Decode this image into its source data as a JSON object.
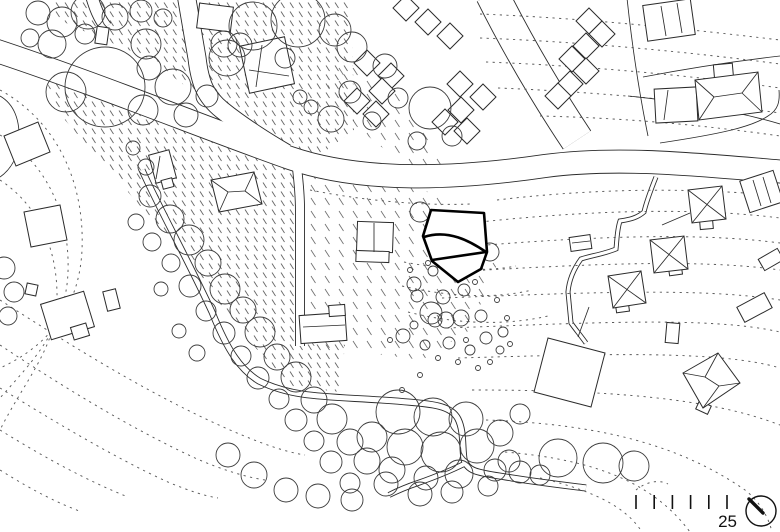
{
  "colors": {
    "background": "#ffffff",
    "ink": "#2b2b2b",
    "contour": "#5a5a5a",
    "bold_outline": "#000000"
  },
  "scale_bar": {
    "label": "25",
    "tick_count": 6,
    "x0": 636,
    "step": 18.2,
    "y1": 495,
    "y2": 509
  },
  "north_symbol": {
    "cx": 761,
    "cy": 511,
    "r": 15,
    "hand": [
      749,
      499,
      763,
      513
    ]
  },
  "plan": {
    "hatch_regions": [
      {
        "density": "dense",
        "pts": "35,50 120,85 210,125 290,158 305,175 305,330 345,345 340,392 288,386 232,320 178,250 122,185 58,112"
      },
      {
        "density": "dense",
        "pts": "55,0 352,0 354,130 302,168 228,118 148,58 86,32 55,18"
      },
      {
        "density": "sparse",
        "pts": "308,172 420,188 468,212 498,262 470,330 422,360 308,345"
      },
      {
        "density": "sparse",
        "pts": "336,58 396,92 428,138 466,184 420,178 358,128 326,92"
      }
    ],
    "roads": [
      {
        "d": "M-6,50 C100,85 210,130 290,158 C360,182 450,180 545,166 C620,156 700,165 786,172",
        "w": 24
      },
      {
        "d": "M186,-6 L197,58 C200,84 206,97 222,110 C242,126 262,139 286,153",
        "w": 19
      },
      {
        "d": "M91,-6 C95,8 99,18 106,27",
        "w": 13
      },
      {
        "d": "M297,168 C299,185 300,195 300,210 L300,346",
        "w": 10
      },
      {
        "d": "M142,170 C160,210 186,256 212,312 C228,352 241,370 259,381 C296,399 330,396 396,401 C432,404 451,405 458,419 C464,431 462,446 464,459 C467,473 482,473 512,478 C537,482 562,485 586,488",
        "w": 7
      },
      {
        "d": "M464,464 C448,472 432,478 418,483 C406,487 397,491 389,495",
        "w": 6
      },
      {
        "d": "M492,-6 C515,40 545,92 577,140",
        "w": 34
      },
      {
        "d": "M656,177 C650,192 646,203 644,212 C636,219 626,220 620,221 C617,230 617,240 616,249 C604,254 590,256 581,259 C573,270 569,280 568,292 C569,303 570,313 571,323 C576,330 581,336 586,343",
        "w": 5
      }
    ],
    "contours": [
      "M480,14 C580,18 680,28 780,40",
      "M480,38 C585,42 690,52 780,64",
      "M486,62 C590,66 695,76 780,88",
      "M498,88 C600,92 700,102 780,113",
      "M540,116 C630,118 710,126 780,136",
      "M310,190 C360,200 420,206 470,204",
      "M497,200 C580,190 680,186 780,196",
      "M480,222 C575,212 685,206 780,218",
      "M462,247 C570,238 690,231 780,243",
      "M450,272 C575,265 695,258 780,270",
      "M442,298 C580,293 700,287 780,300",
      "M447,328 C590,323 710,316 780,332",
      "M458,358 C600,354 720,350 780,368",
      "M472,390 C610,390 710,398 780,425",
      "M486,420 C600,424 680,445 745,490 C758,500 768,515 772,532",
      "M505,452 C600,460 655,485 690,532",
      "M540,478 C600,492 628,510 642,532",
      "M404,262 C445,270 485,272 516,266",
      "M402,286 C450,297 495,299 532,290",
      "M408,312 C455,324 505,326 548,316",
      "M0,90 C55,120 85,180 82,250 C79,315 40,350 0,368",
      "M0,135 C45,162 70,212 68,272 C66,328 32,362 0,398",
      "M0,180 C38,205 58,248 57,300 C56,348 25,380 0,430",
      "M0,300 C70,345 150,395 230,430 C260,443 285,452 305,455",
      "M0,345 C60,385 130,428 195,458 C220,469 245,477 265,480",
      "M0,388 C55,422 115,458 170,483 C190,491 205,496 218,498",
      "M0,430 C45,458 90,482 128,497",
      "M0,470 C35,492 60,504 82,512",
      "M636,490 C646,482 658,479 668,484"
    ],
    "parcel_lines": [
      "M643,77 C700,66 745,60 780,56",
      "M628,96 C680,101 740,112 780,124",
      "M627,-2 C632,45 639,92 648,136",
      "M660,143 C720,134 752,127 768,116 C778,110 780,102 779,90",
      "M662,225 L690,213",
      "M578,337 L589,307",
      "M0,96 C14,104 20,120 19,140 C18,158 10,170 0,177"
    ],
    "buildings": {
      "rects": [
        {
          "r": [
            198,
            5,
            34,
            25
          ],
          "a": 7
        },
        {
          "r": [
            244,
            41,
            46,
            48
          ],
          "a": -12
        },
        {
          "r": [
            96,
            27,
            12,
            17
          ],
          "a": 8
        },
        {
          "r": [
            152,
            152,
            21,
            29
          ],
          "a": -15
        },
        {
          "r": [
            162,
            179,
            11,
            9
          ],
          "a": -15
        },
        {
          "r": [
            357,
            222,
            36,
            30
          ],
          "a": 2
        },
        {
          "r": [
            356,
            251,
            33,
            11
          ],
          "a": 2
        },
        {
          "r": [
            300,
            314,
            46,
            28
          ],
          "a": -4
        },
        {
          "r": [
            329,
            305,
            16,
            11
          ],
          "a": -4
        },
        {
          "r": [
            655,
            88,
            42,
            34
          ],
          "a": -3
        },
        {
          "r": [
            714,
            64,
            19,
            16
          ],
          "a": -5
        },
        {
          "r": [
            645,
            2,
            48,
            36
          ],
          "a": -8
        },
        {
          "r": [
            744,
            175,
            35,
            33
          ],
          "a": -18
        },
        {
          "r": [
            570,
            236,
            21,
            14
          ],
          "a": -8
        },
        {
          "r": [
            666,
            323,
            13,
            20
          ],
          "a": 5
        },
        {
          "r": [
            739,
            299,
            31,
            17
          ],
          "a": -28
        },
        {
          "r": [
            760,
            253,
            22,
            13
          ],
          "a": -30
        },
        {
          "r": [
            26,
            284,
            11,
            11
          ],
          "a": 12
        },
        {
          "r": [
            45,
            297,
            45,
            37
          ],
          "a": -17
        },
        {
          "r": [
            72,
            325,
            16,
            13
          ],
          "a": -17
        },
        {
          "r": [
            105,
            290,
            13,
            20
          ],
          "a": -14
        },
        {
          "r": [
            700,
            221,
            13,
            8
          ],
          "a": -5
        },
        {
          "r": [
            669,
            267,
            13,
            8
          ],
          "a": -8
        },
        {
          "r": [
            616,
            304,
            13,
            8
          ],
          "a": -8
        },
        {
          "r": [
            697,
            403,
            13,
            9
          ],
          "a": 25
        },
        {
          "r": [
            247,
            180,
            10,
            12
          ],
          "a": -12
        }
      ],
      "polys": [
        "211,180 254,172 262,204 219,212",
        "688,190 722,186 726,219 692,223",
        "650,240 684,236 688,269 654,273",
        "608,276 641,271 646,303 613,308",
        "718,353 740,383 703,408 683,373",
        "695,80 758,72 762,112 699,120",
        "548,338 605,353 591,407 534,392",
        "24,212 60,205 67,240 31,247",
        "4,136 38,122 50,152 16,166"
      ],
      "diamond_half": 13,
      "diamonds": [
        [
          367,
          63
        ],
        [
          391,
          76
        ],
        [
          382,
          91
        ],
        [
          357,
          101
        ],
        [
          376,
          114
        ],
        [
          460,
          84
        ],
        [
          483,
          97
        ],
        [
          461,
          110
        ],
        [
          445,
          122
        ],
        [
          467,
          131
        ],
        [
          406,
          8
        ],
        [
          428,
          22
        ],
        [
          450,
          36
        ],
        [
          589,
          21
        ],
        [
          602,
          34
        ],
        [
          586,
          46
        ],
        [
          572,
          59
        ],
        [
          586,
          71
        ],
        [
          570,
          84
        ],
        [
          558,
          96
        ]
      ]
    },
    "roof_lines": [
      "M211,180 L228,192",
      "M219,212 L228,192",
      "M254,172 L245,191",
      "M262,204 L245,191",
      "M228,192 L245,191",
      "M374,223 L374,252",
      "M688,190 L726,219",
      "M722,186 L692,223",
      "M650,240 L688,269",
      "M684,236 L654,273",
      "M608,276 L646,303",
      "M641,271 L613,308",
      "M718,353 L705,377",
      "M683,373 L705,377",
      "M740,383 L719,386",
      "M703,408 L719,386",
      "M705,377 L719,386",
      "M695,80 L714,97",
      "M699,120 L714,97",
      "M758,72 L742,93",
      "M762,112 L742,93",
      "M714,97 L742,93",
      "M668,90 L664,120",
      "M661,6 L666,36",
      "M677,3 L682,33",
      "M753,180 L761,206",
      "M763,177 L771,203",
      "M572,243 L590,241",
      "M160,156 L156,179",
      "M262,45 L256,87",
      "M249,70 L289,76",
      "M303,327 L345,325"
    ],
    "trees": [
      [
        38,
        13,
        12
      ],
      [
        62,
        22,
        15
      ],
      [
        88,
        12,
        17
      ],
      [
        115,
        17,
        13
      ],
      [
        141,
        11,
        11
      ],
      [
        163,
        18,
        9
      ],
      [
        30,
        38,
        9
      ],
      [
        52,
        44,
        14
      ],
      [
        85,
        34,
        10
      ],
      [
        146,
        44,
        15
      ],
      [
        149,
        68,
        12
      ],
      [
        105,
        87,
        40
      ],
      [
        66,
        92,
        20
      ],
      [
        173,
        87,
        18
      ],
      [
        143,
        110,
        15
      ],
      [
        186,
        115,
        12
      ],
      [
        207,
        96,
        11
      ],
      [
        227,
        58,
        18
      ],
      [
        224,
        44,
        13
      ],
      [
        240,
        45,
        12
      ],
      [
        253,
        26,
        24
      ],
      [
        298,
        20,
        27
      ],
      [
        335,
        30,
        16
      ],
      [
        285,
        58,
        10
      ],
      [
        352,
        47,
        15
      ],
      [
        385,
        66,
        12
      ],
      [
        350,
        92,
        11
      ],
      [
        331,
        119,
        13
      ],
      [
        372,
        121,
        9
      ],
      [
        398,
        98,
        10
      ],
      [
        430,
        108,
        21
      ],
      [
        452,
        136,
        10
      ],
      [
        417,
        141,
        9
      ],
      [
        300,
        97,
        7
      ],
      [
        311,
        107,
        7
      ],
      [
        146,
        167,
        8
      ],
      [
        133,
        148,
        7
      ],
      [
        150,
        196,
        11
      ],
      [
        170,
        219,
        14
      ],
      [
        152,
        242,
        9
      ],
      [
        189,
        240,
        15
      ],
      [
        171,
        263,
        9
      ],
      [
        208,
        263,
        13
      ],
      [
        190,
        286,
        11
      ],
      [
        225,
        289,
        15
      ],
      [
        206,
        311,
        10
      ],
      [
        243,
        310,
        13
      ],
      [
        224,
        333,
        11
      ],
      [
        260,
        332,
        15
      ],
      [
        241,
        356,
        10
      ],
      [
        277,
        357,
        13
      ],
      [
        258,
        378,
        11
      ],
      [
        296,
        377,
        15
      ],
      [
        279,
        399,
        10
      ],
      [
        314,
        400,
        13
      ],
      [
        296,
        420,
        11
      ],
      [
        332,
        419,
        15
      ],
      [
        314,
        441,
        10
      ],
      [
        350,
        442,
        13
      ],
      [
        331,
        462,
        11
      ],
      [
        367,
        461,
        13
      ],
      [
        350,
        483,
        10
      ],
      [
        386,
        484,
        12
      ],
      [
        136,
        222,
        8
      ],
      [
        161,
        289,
        7
      ],
      [
        179,
        331,
        7
      ],
      [
        197,
        353,
        8
      ],
      [
        398,
        412,
        22
      ],
      [
        433,
        417,
        19
      ],
      [
        466,
        419,
        17
      ],
      [
        372,
        437,
        15
      ],
      [
        405,
        447,
        18
      ],
      [
        441,
        452,
        20
      ],
      [
        477,
        446,
        17
      ],
      [
        500,
        433,
        13
      ],
      [
        459,
        474,
        14
      ],
      [
        426,
        478,
        12
      ],
      [
        392,
        470,
        13
      ],
      [
        509,
        461,
        11
      ],
      [
        520,
        414,
        10
      ],
      [
        488,
        486,
        10
      ],
      [
        452,
        492,
        11
      ],
      [
        420,
        494,
        12
      ],
      [
        228,
        455,
        12
      ],
      [
        254,
        475,
        13
      ],
      [
        286,
        490,
        12
      ],
      [
        318,
        496,
        12
      ],
      [
        352,
        500,
        11
      ],
      [
        495,
        470,
        11
      ],
      [
        520,
        472,
        11
      ],
      [
        540,
        475,
        10
      ],
      [
        558,
        458,
        19
      ],
      [
        603,
        463,
        20
      ],
      [
        634,
        466,
        15
      ],
      [
        420,
        212,
        10
      ],
      [
        490,
        252,
        9
      ],
      [
        414,
        284,
        7
      ],
      [
        417,
        296,
        6
      ],
      [
        443,
        297,
        7
      ],
      [
        464,
        290,
        6
      ],
      [
        481,
        316,
        6
      ],
      [
        461,
        318,
        8
      ],
      [
        435,
        320,
        7
      ],
      [
        486,
        338,
        6
      ],
      [
        503,
        332,
        5
      ],
      [
        449,
        343,
        6
      ],
      [
        470,
        350,
        5
      ],
      [
        425,
        345,
        5
      ],
      [
        414,
        325,
        4
      ],
      [
        500,
        350,
        4
      ],
      [
        433,
        271,
        5
      ],
      [
        452,
        270,
        4
      ],
      [
        431,
        313,
        11
      ],
      [
        446,
        320,
        8
      ],
      [
        403,
        336,
        7
      ],
      [
        4,
        268,
        11
      ],
      [
        14,
        292,
        10
      ],
      [
        8,
        316,
        9
      ]
    ],
    "shrubs": [
      [
        410,
        270
      ],
      [
        428,
        263
      ],
      [
        475,
        282
      ],
      [
        497,
        300
      ],
      [
        507,
        318
      ],
      [
        438,
        358
      ],
      [
        458,
        362
      ],
      [
        478,
        368
      ],
      [
        420,
        375
      ],
      [
        402,
        390
      ],
      [
        490,
        362
      ],
      [
        510,
        344
      ],
      [
        390,
        340
      ],
      [
        466,
        340
      ]
    ],
    "bold_building": {
      "outline": "M431,210 L484,213 L487,252 L481,269 L458,282 L432,261 L423,236 Z",
      "inner": [
        "M424,237 C448,229 470,241 486,252",
        "M432,260 L486,252"
      ]
    }
  }
}
